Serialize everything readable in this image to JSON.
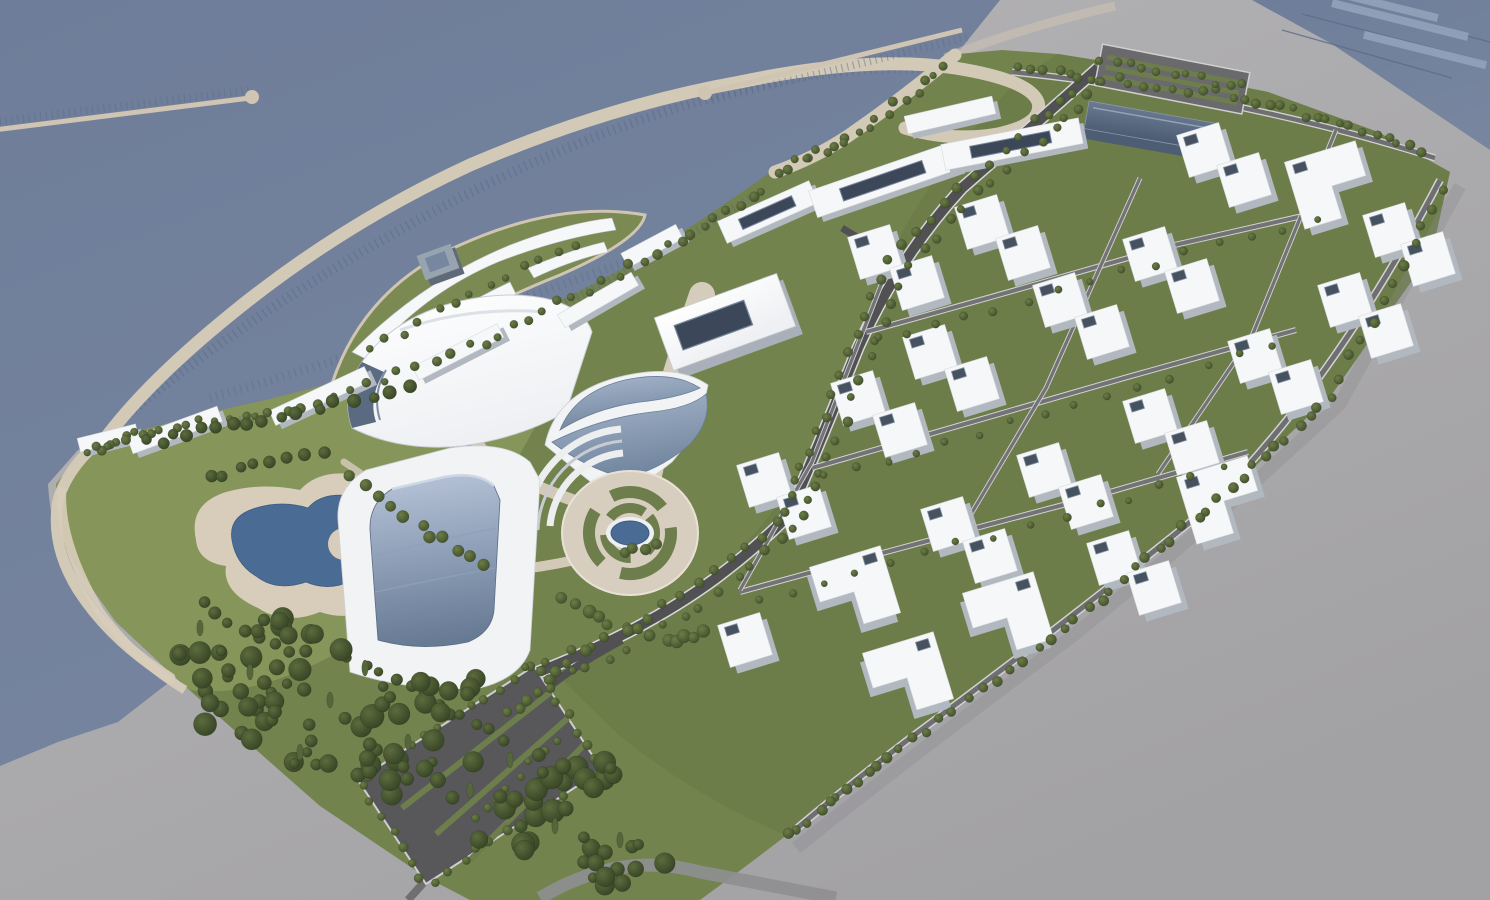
{
  "image": {
    "kind": "3d-architectural-masterplan-aerial-rendering",
    "width": 1490,
    "height": 900
  },
  "regions": [
    {
      "name": "open-sea"
    },
    {
      "name": "marina-basin"
    },
    {
      "name": "marina-breakwater-ring"
    },
    {
      "name": "yacht-club-island"
    },
    {
      "name": "floating-piers"
    },
    {
      "name": "office-waterfront-buildings"
    },
    {
      "name": "civic-halls"
    },
    {
      "name": "glass-crescent-building"
    },
    {
      "name": "curved-hotel-tower"
    },
    {
      "name": "circular-plaza-fountain"
    },
    {
      "name": "residential-district"
    },
    {
      "name": "park-pond"
    },
    {
      "name": "woodland"
    },
    {
      "name": "parking-lot"
    },
    {
      "name": "ground-plane"
    }
  ],
  "palette": {
    "seaTop": "#6e7d99",
    "seaBottom": "#77859f",
    "bgTop": "#b6b5b8",
    "bgBottom": "#a2a1a3",
    "bgRoad": "#8f8f92",
    "lawn": "#73834d",
    "lawnPark": "#87975c",
    "lawnResidential": "#6d7d49",
    "islandGreen": "#7a8a52",
    "treeLight": "#66763f",
    "treeDark": "#3f4e2b",
    "woodLight": "#5c6c3d",
    "woodDark": "#344224",
    "cypress": "#55663a",
    "roadDark": "#515154",
    "roadMid": "#6f6f72",
    "curb": "#d2d2d5",
    "parkingAsphalt": "#58585b",
    "greenStrip": "#6d7d4b",
    "promenade": "#d3c9b7",
    "beach": "#d8cdba",
    "plaza": "#d8cec0",
    "slip": "#5a6a87",
    "whiteRoof": "#f6f7f9",
    "sideShade": "#b2b8c0",
    "roofCore": "#46525f",
    "roofCoreEdge": "#8593a5",
    "darkPanel": "#3c4859",
    "darkPanelEdge": "#77879b",
    "glassLight": "#a7b7cc",
    "glassDark": "#72869f",
    "hotelTop": "#b7c3d7",
    "hotelBottom": "#677a93",
    "hotelEdge": "#cdd8e6",
    "darkGlassTop": "#6a7a92",
    "darkGlassFront": "#4d5d73",
    "pond": "#4a6b93",
    "pondEdge": "#3e5c82",
    "fountainRim": "#edeff1",
    "ribbedFacade": "#5a6a80"
  }
}
